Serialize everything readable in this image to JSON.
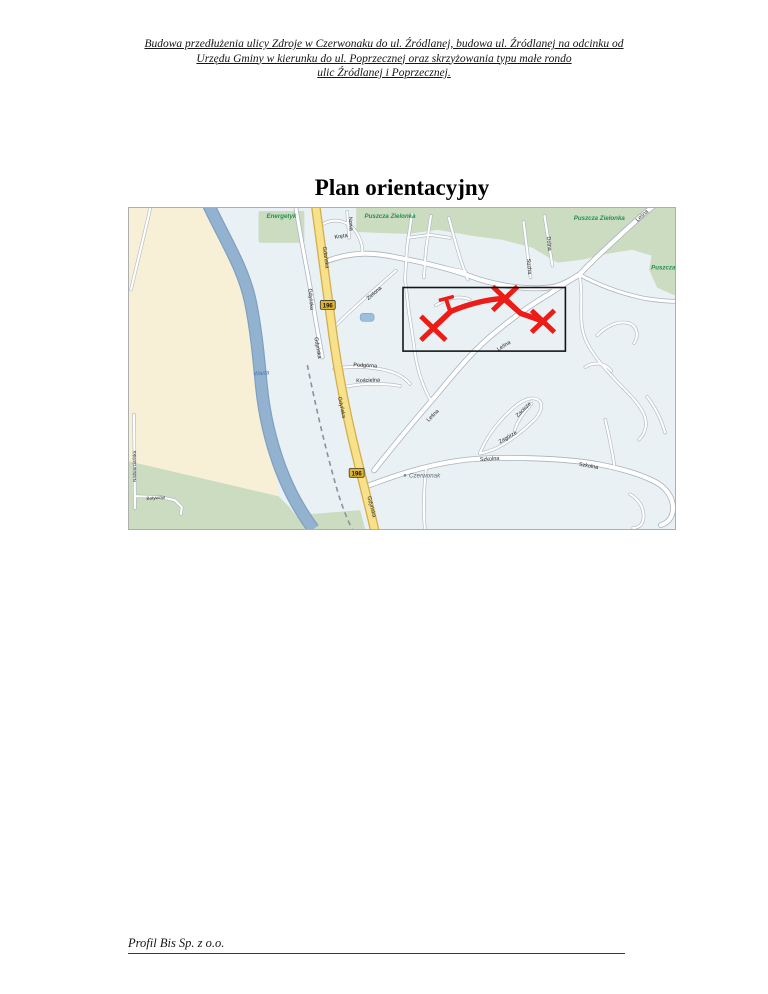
{
  "document": {
    "header_lines": [
      "Budowa przedłużenia ulicy Zdroje w Czerwonaku do ul. Źródlanej, budowa ul. Źródlanej na odcinku od",
      "Urzędu Gminy w kierunku do ul. Poprzecznej oraz skrzyżowania typu małe rondo",
      "ulic Źródlanej i Poprzecznej."
    ],
    "title": "Plan orientacyjny",
    "footer": "Profil Bis Sp. z o.o."
  },
  "map": {
    "area_labels": [
      {
        "text": "Energetyk"
      },
      {
        "text": "Puszcza Zielonka"
      },
      {
        "text": "Puszcza Zielonka"
      },
      {
        "text": "Puszcza"
      },
      {
        "text": "Warta"
      },
      {
        "text": "Czerwonak"
      }
    ],
    "street_labels": [
      {
        "text": "Kręta"
      },
      {
        "text": "Nowa"
      },
      {
        "text": "Zielona"
      },
      {
        "text": "Gdańska"
      },
      {
        "text": "Gdyńska"
      },
      {
        "text": "Gdyńska"
      },
      {
        "text": "Gdyńska"
      },
      {
        "text": "Gdyńska"
      },
      {
        "text": "Sucha"
      },
      {
        "text": "Dolna"
      },
      {
        "text": "Leśna"
      },
      {
        "text": "Leśna"
      },
      {
        "text": "Leśna"
      },
      {
        "text": "Podgórna"
      },
      {
        "text": "Kościelna"
      },
      {
        "text": "Zacisze"
      },
      {
        "text": "Zagórze"
      },
      {
        "text": "Szkolna"
      },
      {
        "text": "Szkolna"
      },
      {
        "text": "Botywoja"
      },
      {
        "text": "Nadwarciańska"
      }
    ],
    "route_badges": [
      "196",
      "196"
    ],
    "colors": {
      "highlight": "#ed1c16",
      "water": "#92b2d0",
      "forest": "#cbdcc0",
      "land_west": "#f8f0d6",
      "urban": "#e9f1f5",
      "main_road": "#f7e18b"
    }
  }
}
